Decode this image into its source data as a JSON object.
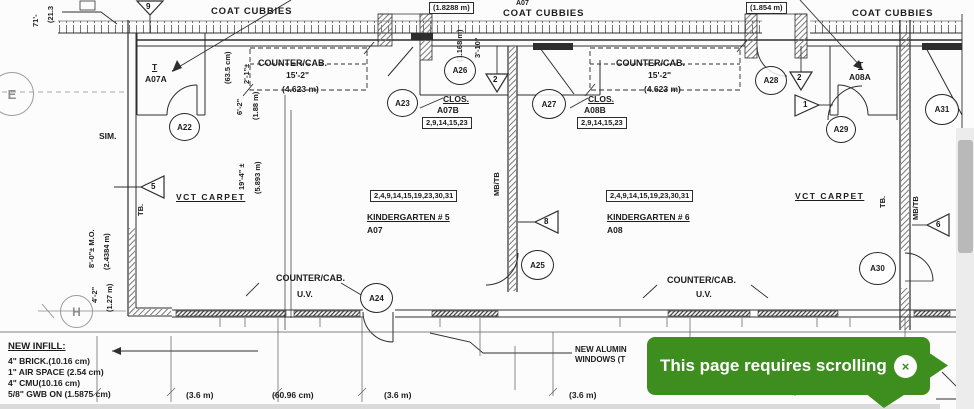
{
  "toast": {
    "message": "This page requires scrolling",
    "close_icon": "×",
    "bg_color": "#3E8E1F"
  },
  "plan": {
    "coat_cubbies": [
      "COAT CUBBIES",
      "COAT CUBBIES",
      "COAT CUBBIES"
    ],
    "top_door_dims": [
      "(1.8288 m)",
      "(1.854 m)"
    ],
    "top_room_ref": "A07",
    "counters": [
      {
        "name": "COUNTER/CAB.",
        "length": "15'-2\"",
        "metric": "(4.623 m)"
      },
      {
        "name": "COUNTER/CAB.",
        "length": "15'-2\"",
        "metric": "(4.623 m)"
      }
    ],
    "uv_counters": [
      {
        "name": "COUNTER/CAB.",
        "sub": "U.V."
      },
      {
        "name": "COUNTER/CAB.",
        "sub": "U.V."
      }
    ],
    "rooms": [
      {
        "finish_keys": "2,4,9,14,15,19,23,30,31",
        "name": "KINDERGARTEN # 5",
        "number": "A07"
      },
      {
        "finish_keys": "2,4,9,14,15,19,23,30,31",
        "name": "KINDERGARTEN # 6",
        "number": "A08"
      }
    ],
    "closets": [
      {
        "label": "CLOS.",
        "number": "A07B",
        "finish_keys": "2,9,14,15,23"
      },
      {
        "label": "CLOS.",
        "number": "A08B",
        "finish_keys": "2,9,14,15,23"
      }
    ],
    "door_tags": [
      {
        "symbol": "T",
        "number": "A07A"
      },
      {
        "symbol": "T",
        "number": "A08A"
      }
    ],
    "room_tags": [
      "A22",
      "A23",
      "A24",
      "A25",
      "A26",
      "A27",
      "A28",
      "A29",
      "A30",
      "A31"
    ],
    "keynotes": [
      "9",
      "2",
      "2",
      "1",
      "5",
      "8",
      "6"
    ],
    "grid_bubbles": [
      "E",
      "H"
    ],
    "finishes": {
      "vct_left": "VCT CARPET",
      "vct_right": "VCT CARPET",
      "tb_left": "TB.",
      "tb_right": "TB.",
      "mbtb_center": "MB/TB",
      "mbtb_right": "MB/TB",
      "sim": "SIM."
    },
    "vertical_dims": {
      "left_top_a": "71'-",
      "left_top_b": "(21.3",
      "d1a": "2'-1\"±",
      "d1b": "(63.5 cm)",
      "d2a": "6'-2\"",
      "d2b": "(1.88 m)",
      "d3a": "3'-10\"",
      "d3b": "(1.168 m)",
      "d4a": "19'-4\" ±",
      "d4b": "(5.893 m)",
      "d5a": "8'-0\"± M.O.",
      "d5b": "(2.4384 m)",
      "d6a": "4'-2\"",
      "d6b": "(1.27 m)"
    },
    "bottom_dims": [
      "(3.6 m)",
      "(60.96 cm)",
      "(3.6 m)",
      "(3.6 m)"
    ],
    "new_infill": {
      "title": "NEW INFILL:",
      "lines": [
        "4\" BRICK.(10.16 cm)",
        "1\" AIR SPACE (2.54 cm)",
        "4\" CMU(10.16 cm)",
        "5/8\" GWB ON (1.5875 cm)"
      ]
    },
    "window_note": {
      "line1": "NEW ALUMIN",
      "line2": "WINDOWS (T"
    }
  }
}
